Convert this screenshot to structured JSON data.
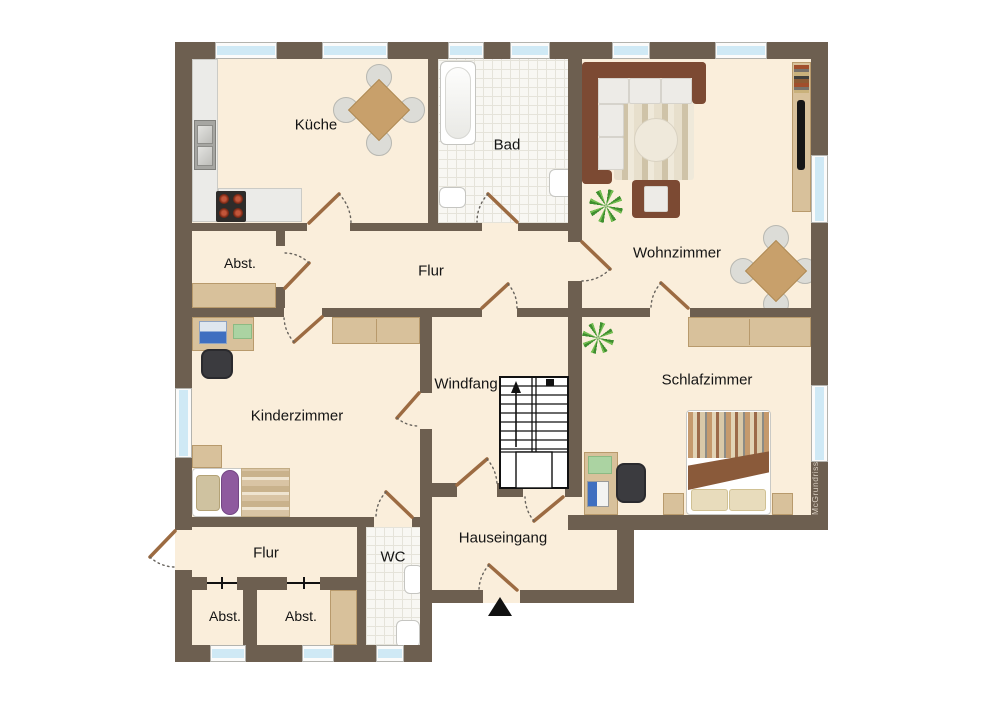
{
  "watermark": "McGrundriss",
  "rooms": {
    "kueche": {
      "label": "Küche"
    },
    "bad": {
      "label": "Bad"
    },
    "wohnzimmer": {
      "label": "Wohnzimmer"
    },
    "abst_oben": {
      "label": "Abst."
    },
    "flur": {
      "label": "Flur"
    },
    "kinderzimmer": {
      "label": "Kinderzimmer"
    },
    "windfang": {
      "label": "Windfang"
    },
    "schlafzimmer": {
      "label": "Schlafzimmer"
    },
    "hauseingang": {
      "label": "Hauseingang"
    },
    "wc": {
      "label": "WC"
    },
    "flur_unten": {
      "label": "Flur"
    },
    "abst_unten_links": {
      "label": "Abst."
    },
    "abst_unten_rechts": {
      "label": "Abst."
    }
  },
  "colors": {
    "wall": "#6d5f50",
    "floor": "#faeedb",
    "tile": "#f8f7f3",
    "window_glass": "#cfe9f5",
    "door_leaf": "#9c6b42",
    "wood": "#d8c19b",
    "sofa": "#7c4a33",
    "table": "#c8a06b",
    "plant": "#3f8f2f"
  }
}
